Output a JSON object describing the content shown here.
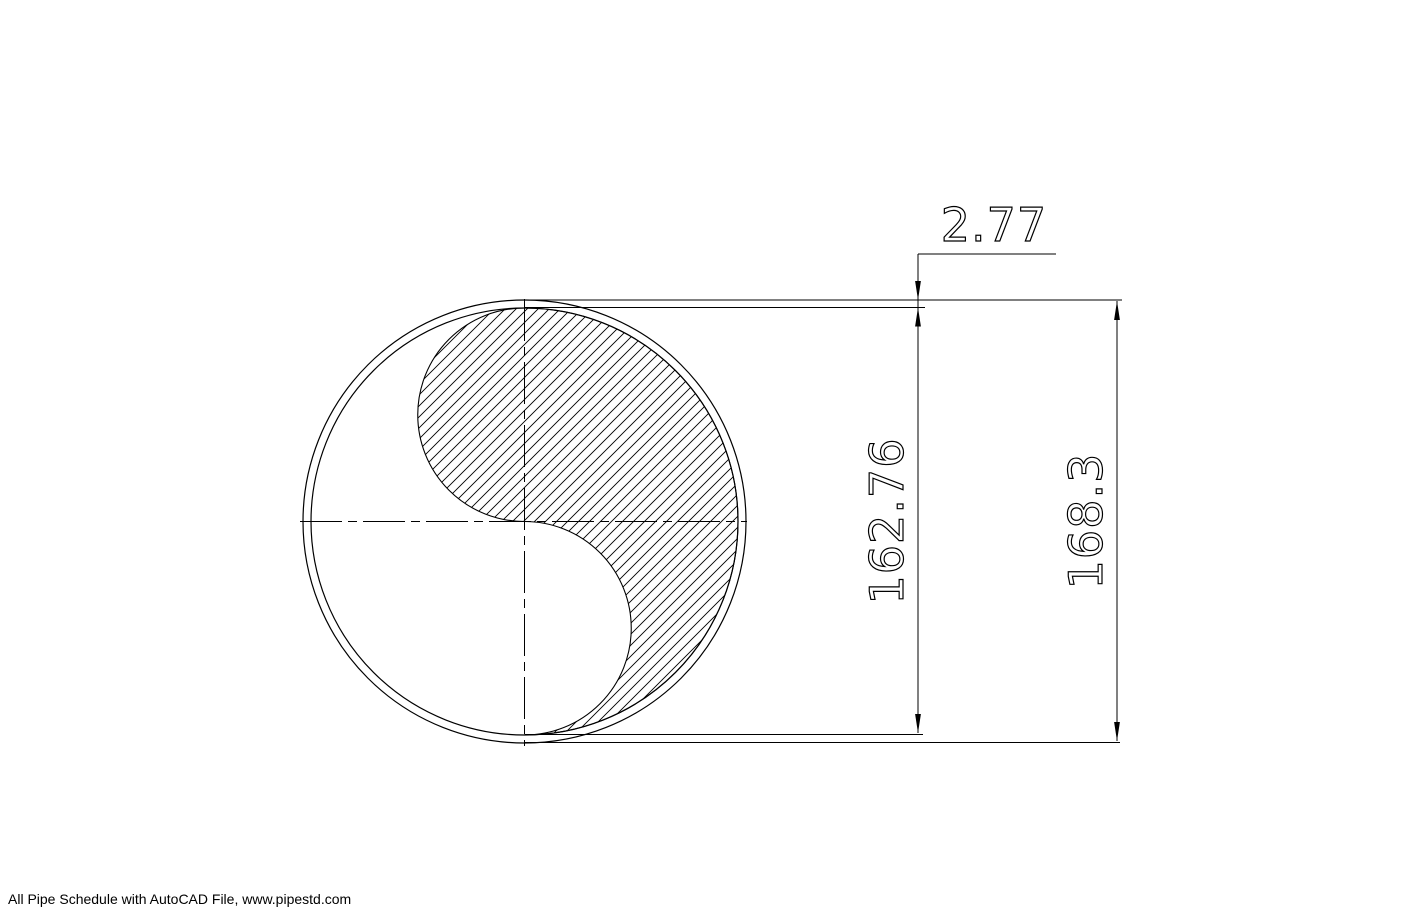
{
  "drawing": {
    "dimensions": {
      "wall_thickness": "2.77",
      "inner_diameter": "162.76",
      "outer_diameter": "168.3"
    },
    "footer": "All Pipe Schedule with AutoCAD File, www.pipestd.com",
    "colors": {
      "line": "#000000",
      "background": "#ffffff"
    }
  }
}
